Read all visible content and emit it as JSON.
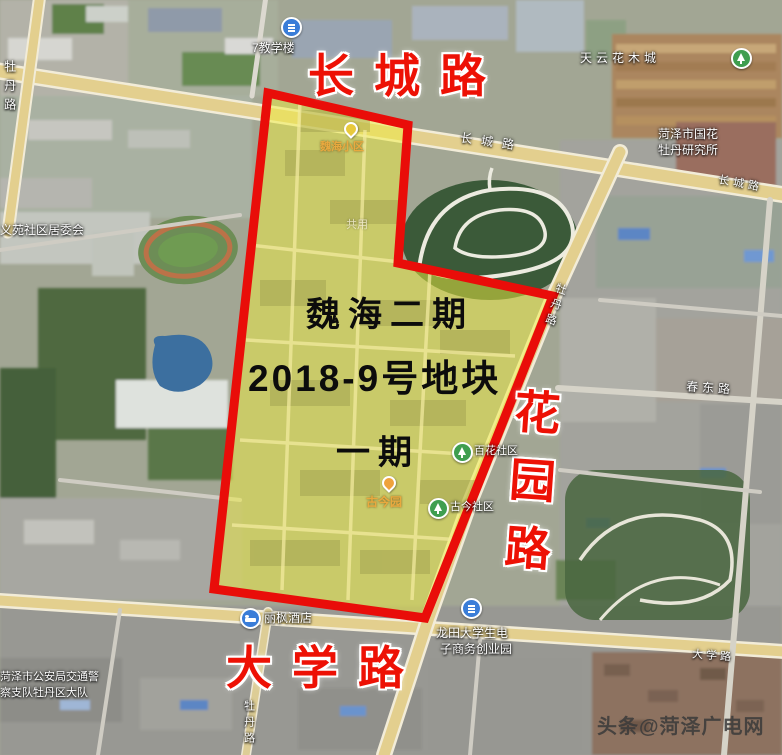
{
  "big_labels": {
    "changcheng_road": "长城路",
    "daxue_road": "大学路",
    "huayuan_road": "花园路"
  },
  "parcel": {
    "line1": "魏海二期",
    "line2": "2018-9号地块",
    "line3": "一期"
  },
  "map_labels": {
    "teaching_building": "7教学楼",
    "tianyun_flower_market": "天云花木城",
    "peony_institute_line1": "菏泽市国花",
    "peony_institute_line2": "牡丹研究所",
    "changcheng_small_1": "长城路",
    "changcheng_small_2": "长城路",
    "mudan_road_left": "牡丹路",
    "mudan_road_right": "牡丹路",
    "mudan_road_bottom": "牡丹路",
    "yiyuan_committee": "义苑社区居委会",
    "chundong_road": "春东路",
    "baihua_community": "百花社区",
    "gujin_community": "古今社区",
    "gujin_garden": "古今园",
    "weihai_poi": "魏海小区",
    "gongyong": "共用",
    "lifeng_hotel": "丽枫酒店",
    "longtian_line1": "龙田大学生电",
    "longtian_line2": "子商务创业园",
    "daxue_small": "大学路",
    "traffic_police_line1": "菏泽市公安局交通警",
    "traffic_police_line2": "察支队牡丹区大队"
  },
  "watermark": "头条@菏泽广电网",
  "colors": {
    "boundary_red": "#e90d09",
    "parcel_yellow": "#f0ee3e",
    "annotation_red": "#ed1105",
    "annotation_black": "#0c0c0c",
    "label_white": "#ffffff",
    "poi_orange": "#e9a93f",
    "watermark_gray": "#3a3a3a"
  }
}
